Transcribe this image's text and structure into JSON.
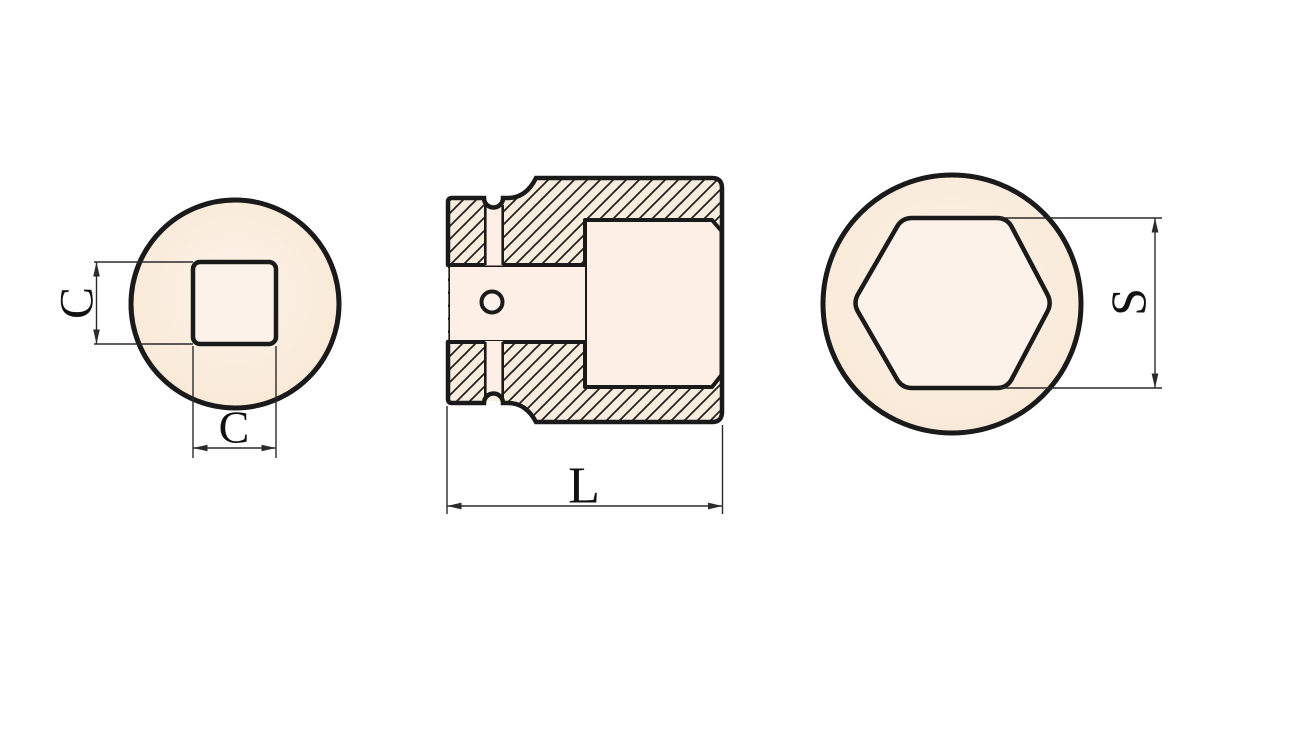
{
  "figure": {
    "type": "technical-drawing",
    "subject": "impact-socket three-view drawing",
    "labels": {
      "c_vertical": "C",
      "c_horizontal": "C",
      "length": "L",
      "across_flats": "S"
    },
    "views": {
      "left": "square-drive-end-view",
      "middle": "cross-section-view",
      "right": "hex-opening-end-view"
    },
    "colors": {
      "background": "#ffffff",
      "outline": "#1a1a1a",
      "dimension": "#2b2b2b",
      "hatch_line": "#1f1f1f",
      "body_fill": "#f8eddc",
      "bore_fill": "#fdeee6",
      "hole_fill": "#fdf2ea",
      "face_fill_center": "#fdf4ea",
      "face_fill_edge": "#f8e7d4"
    }
  }
}
